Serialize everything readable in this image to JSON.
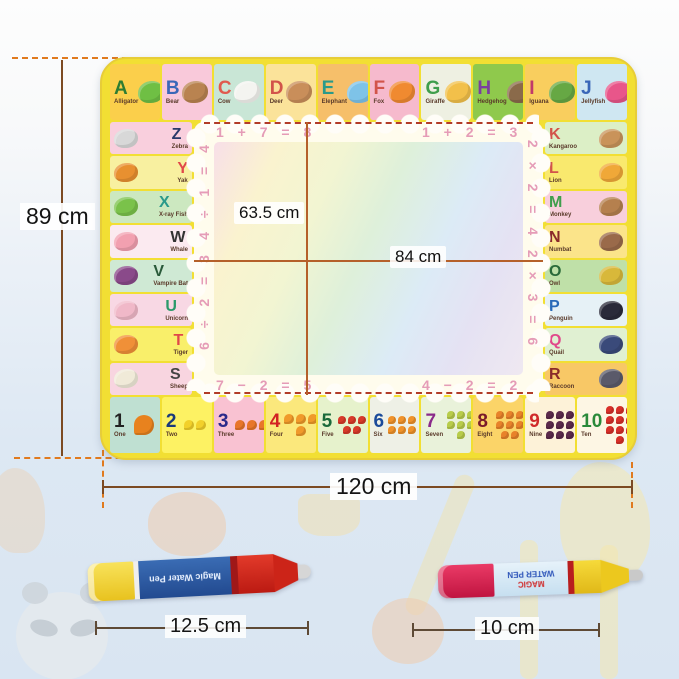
{
  "dimensions": {
    "mat_height": "89 cm",
    "mat_width": "120 cm",
    "inner_height": "63.5 cm",
    "inner_width": "84 cm",
    "pen_left_length": "12.5 cm",
    "pen_right_length": "10 cm"
  },
  "equations": {
    "top_left": "1 + 7 = 8",
    "top_right": "1 + 2 = 3",
    "left_top": "4 ÷ 1 = 4",
    "left_bottom": "6 ÷ 2 = 3",
    "right_top": "2 × 2 = 4",
    "right_bottom": "2 × 3 = 6",
    "bottom_left": "7 − 2 = 5",
    "bottom_right": "4 − 2 = 2"
  },
  "alphabet": {
    "top": [
      {
        "letter": "A",
        "name": "Alligator",
        "color": "#2e7d32",
        "bg": "#fbcf4b",
        "animal": "#6fbf44"
      },
      {
        "letter": "B",
        "name": "Bear",
        "color": "#3a67b8",
        "bg": "#f9c9da",
        "animal": "#b98350"
      },
      {
        "letter": "C",
        "name": "Cow",
        "color": "#e05a4e",
        "bg": "#c9e6d6",
        "animal": "#f4f4f0"
      },
      {
        "letter": "D",
        "name": "Deer",
        "color": "#d2544a",
        "bg": "#fbe39a",
        "animal": "#c98e5a"
      },
      {
        "letter": "E",
        "name": "Elephant",
        "color": "#2a9a8a",
        "bg": "#f6bf6a",
        "animal": "#7ec3e8"
      },
      {
        "letter": "F",
        "name": "Fox",
        "color": "#d2544a",
        "bg": "#f6bacd",
        "animal": "#f08a30"
      },
      {
        "letter": "G",
        "name": "Giraffe",
        "color": "#3f9e4c",
        "bg": "#eef0e2",
        "animal": "#f2c04a"
      },
      {
        "letter": "H",
        "name": "Hedgehog",
        "color": "#7a3fa0",
        "bg": "#8fc94c",
        "animal": "#8a6a4a"
      },
      {
        "letter": "I",
        "name": "Iguana",
        "color": "#c13a6a",
        "bg": "#f9ce5e",
        "animal": "#66a844"
      },
      {
        "letter": "J",
        "name": "Jellyfish",
        "color": "#3a67b8",
        "bg": "#cfe7f2",
        "animal": "#e8568a"
      }
    ],
    "left": [
      {
        "letter": "Z",
        "name": "Zebra",
        "color": "#2a3a6a",
        "bg": "#f9cfdd",
        "animal": "#d8d8d8"
      },
      {
        "letter": "Y",
        "name": "Yak",
        "color": "#e0484a",
        "bg": "#f8f0a0",
        "animal": "#e89030"
      },
      {
        "letter": "X",
        "name": "X-ray Fish",
        "color": "#2a9a8a",
        "bg": "#cce8c0",
        "animal": "#7ac24a"
      },
      {
        "letter": "W",
        "name": "Whale",
        "color": "#333333",
        "bg": "#fbeaf0",
        "animal": "#f2a0b0"
      },
      {
        "letter": "V",
        "name": "Vampire Bat",
        "color": "#2a5a3a",
        "bg": "#cfe9d4",
        "animal": "#8a4a8a"
      },
      {
        "letter": "U",
        "name": "Unicorn",
        "color": "#2a9a6a",
        "bg": "#f8d8e4",
        "animal": "#f0b8c8"
      },
      {
        "letter": "T",
        "name": "Tiger",
        "color": "#e0484a",
        "bg": "#f9ef6a",
        "animal": "#f09038"
      },
      {
        "letter": "S",
        "name": "Sheep",
        "color": "#444444",
        "bg": "#f8d5e0",
        "animal": "#f0ead8"
      }
    ],
    "right": [
      {
        "letter": "K",
        "name": "Kangaroo",
        "color": "#d2544a",
        "bg": "#dcefc6",
        "animal": "#c9935a"
      },
      {
        "letter": "L",
        "name": "Lion",
        "color": "#d2544a",
        "bg": "#f9e96e",
        "animal": "#f0a838"
      },
      {
        "letter": "M",
        "name": "Monkey",
        "color": "#3f9e4c",
        "bg": "#f8cfdc",
        "animal": "#b5804e"
      },
      {
        "letter": "N",
        "name": "Numbat",
        "color": "#8a2a2a",
        "bg": "#fbe48a",
        "animal": "#9a6a4a"
      },
      {
        "letter": "O",
        "name": "Owl",
        "color": "#2a6a3a",
        "bg": "#bfe0a8",
        "animal": "#d8b83a"
      },
      {
        "letter": "P",
        "name": "Penguin",
        "color": "#2a6ab8",
        "bg": "#e6f1f6",
        "animal": "#2a2a3a"
      },
      {
        "letter": "Q",
        "name": "Quail",
        "color": "#e0488a",
        "bg": "#e0f0d2",
        "animal": "#3a4a7a"
      },
      {
        "letter": "R",
        "name": "Raccoon",
        "color": "#8a2a2a",
        "bg": "#f8c866",
        "animal": "#5a5a6a"
      }
    ]
  },
  "numbers": [
    {
      "value": "1",
      "name": "One",
      "color": "#222222",
      "bg": "#bfe0d2",
      "fruit": "#e8821e",
      "count": 1
    },
    {
      "value": "2",
      "name": "Two",
      "color": "#1a3a7a",
      "bg": "#fdf263",
      "fruit": "#f2d02a",
      "count": 2
    },
    {
      "value": "3",
      "name": "Three",
      "color": "#2a2a8a",
      "bg": "#f9c2d2",
      "fruit": "#e8762a",
      "count": 3
    },
    {
      "value": "4",
      "name": "Four",
      "color": "#d22222",
      "bg": "#fbe87c",
      "fruit": "#f09a2a",
      "count": 4
    },
    {
      "value": "5",
      "name": "Five",
      "color": "#1a6a3a",
      "bg": "#e6f2cc",
      "fruit": "#d83a2a",
      "count": 5
    },
    {
      "value": "6",
      "name": "Six",
      "color": "#1a4a9a",
      "bg": "#eef0e6",
      "fruit": "#f0922a",
      "count": 6
    },
    {
      "value": "7",
      "name": "Seven",
      "color": "#8a2a8a",
      "bg": "#e9f2da",
      "fruit": "#b8cc4a",
      "count": 7
    },
    {
      "value": "8",
      "name": "Eight",
      "color": "#7a1a2a",
      "bg": "#fbd468",
      "fruit": "#e8822a",
      "count": 8
    },
    {
      "value": "9",
      "name": "Nine",
      "color": "#d02a2a",
      "bg": "#fdf2d8",
      "fruit": "#5a2a4a",
      "count": 9
    },
    {
      "value": "10",
      "name": "Ten",
      "color": "#2a8a3a",
      "bg": "#fdf6e4",
      "fruit": "#d8302a",
      "count": 10
    }
  ],
  "pens": {
    "left": {
      "label": "Magic Water Pen"
    },
    "right": {
      "line1": "MAGIC",
      "line2": "WATER PEN"
    }
  },
  "colors": {
    "mat_rim": "#f2df33",
    "equation_pink": "#e59cb7",
    "measure_line": "#7c4a22",
    "dashed_guide": "#e07a1e",
    "crosshair": "#b5602a",
    "background_blue": "#d9e5f2"
  }
}
